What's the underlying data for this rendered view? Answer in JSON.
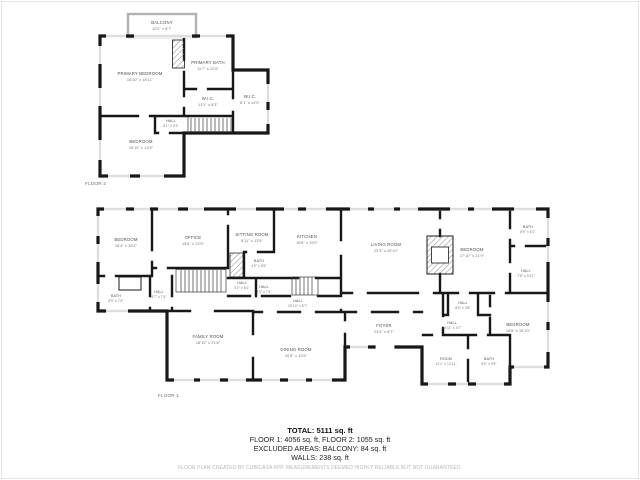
{
  "floor2": {
    "label": "FLOOR 2",
    "rooms": [
      {
        "name": "BALCONY",
        "dims": "10'2\" x 8'7\""
      },
      {
        "name": "PRIMARY BEDROOM",
        "dims": "18'10\" x 18'11\""
      },
      {
        "name": "PRIMARY BATH",
        "dims": "11'7\" x 12'6\""
      },
      {
        "name": "W.I.C.",
        "dims": "13'1\" x 8'3\""
      },
      {
        "name": "W.I.C.",
        "dims": "8'1\" x 14'9\""
      },
      {
        "name": "HALL",
        "dims": "8'1\" x 3'3\""
      },
      {
        "name": "BEDROOM",
        "dims": "18'10\" x 13'9\""
      }
    ]
  },
  "floor1": {
    "label": "FLOOR 1",
    "rooms": [
      {
        "name": "BEDROOM",
        "dims": "15'4\" x 15'2\""
      },
      {
        "name": "OFFICE",
        "dims": "15'8\" x 13'9\""
      },
      {
        "name": "SITTING ROOM",
        "dims": "8'11\" x 13'9\""
      },
      {
        "name": "KITCHEN",
        "dims": "15'9\" x 19'2\""
      },
      {
        "name": "LIVING ROOM",
        "dims": "23'3\" x 26'10\""
      },
      {
        "name": "BEDROOM",
        "dims": "17'10\" x 21'9\""
      },
      {
        "name": "BATH",
        "dims": "8'9\" x 6'1\""
      },
      {
        "name": "HALL",
        "dims": "7'6\" x 5'11\""
      },
      {
        "name": "BATH",
        "dims": "4'9\" x 5'5\""
      },
      {
        "name": "HALL",
        "dims": "4'2\" x 8'1\""
      },
      {
        "name": "HALL",
        "dims": "3'3\" x 7'4\""
      },
      {
        "name": "BATH",
        "dims": "8'9\" x 7'4\""
      },
      {
        "name": "HALL",
        "dims": "4'7\" x 7'4\""
      },
      {
        "name": "FAMILY ROOM",
        "dims": "18'10\" x 21'8\""
      },
      {
        "name": "DINING ROOM",
        "dims": "20'8\" x 13'9\""
      },
      {
        "name": "HALL",
        "dims": "20'10\" x 8'7\""
      },
      {
        "name": "FOYER",
        "dims": "23'4\" x 8'7\""
      },
      {
        "name": "HALL",
        "dims": "12'11\" x 4'7\""
      },
      {
        "name": "HALL",
        "dims": "8'5\" x 3'8\""
      },
      {
        "name": "ROOM",
        "dims": "12'1\" x 12'11\""
      },
      {
        "name": "BATH",
        "dims": "9'9\" x 9'9\""
      },
      {
        "name": "BEDROOM",
        "dims": "18'8\" x 15'10\""
      }
    ]
  },
  "summary": {
    "total": "TOTAL: 5111 sq. ft",
    "floors": "FLOOR 1: 4056 sq. ft, FLOOR 2: 1055 sq. ft",
    "excluded": "EXCLUDED AREAS: BALCONY: 84 sq. ft",
    "walls": "WALLS: 238 sq. ft",
    "disclaimer": "FLOOR PLAN CREATED BY CUBICASA APP. MEASUREMENTS DEEMED HIGHLY RELIABLE BUT NOT GUARANTEED."
  }
}
